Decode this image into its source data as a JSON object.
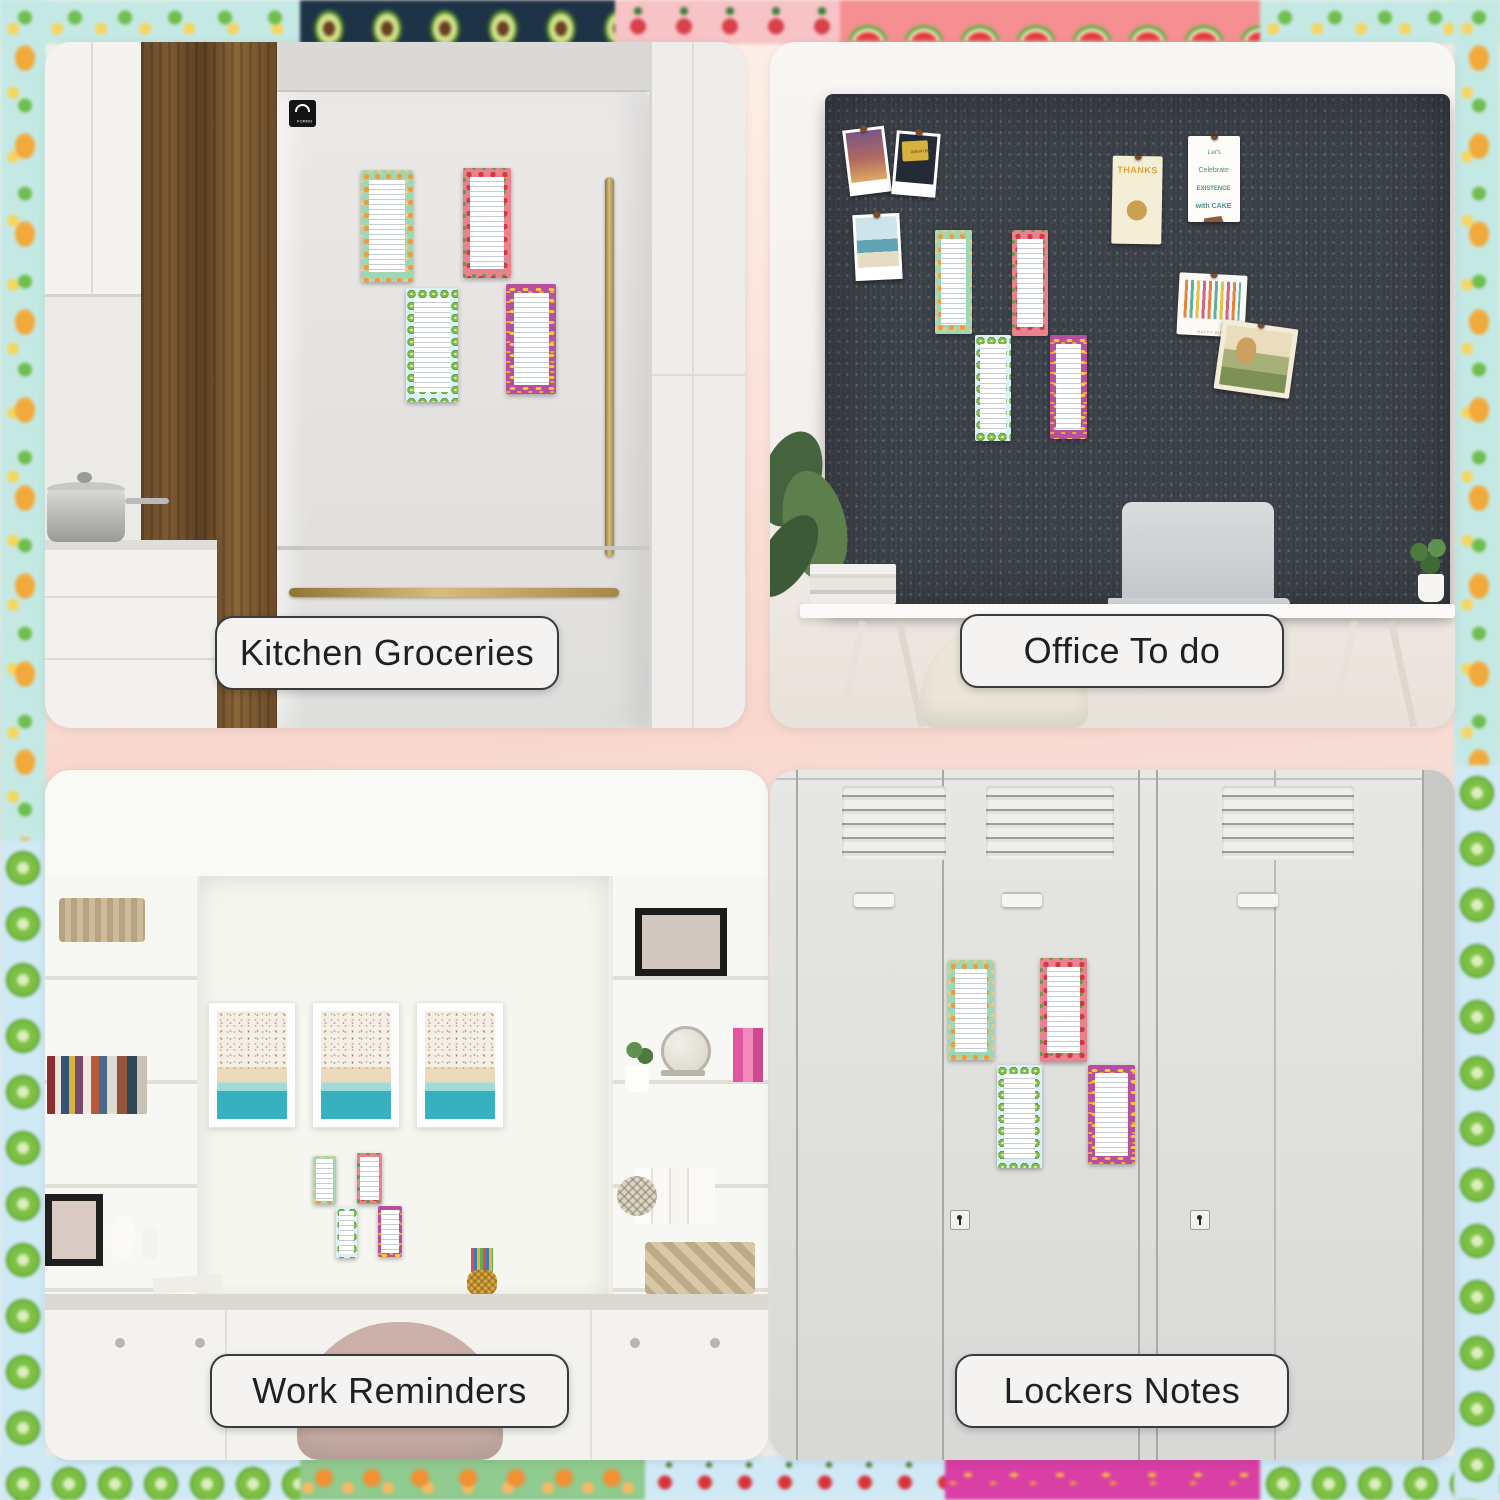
{
  "collage": {
    "type": "magnetic fruit notepads - four lifestyle scenes",
    "quadrants": {
      "kitchen": {
        "label": "Kitchen Groceries",
        "scene": "refrigerator"
      },
      "office": {
        "label": "Office To do",
        "scene": "fabric-bulletin-board-desk"
      },
      "work": {
        "label": "Work Reminders",
        "scene": "home-office-built-in-shelves"
      },
      "lockers": {
        "label": "Lockers Notes",
        "scene": "metal-lockers"
      }
    },
    "fridge_badge": "FORNO",
    "board": {
      "polaroids": [
        "palm-trees-sunset",
        "saturn-bar-sign",
        "beach-shore"
      ],
      "saturn_sign_text": "Saturn Bar",
      "thanks_card_text": "THANKS",
      "cake_card_lines": [
        "Let's",
        "Celebrate",
        "EXISTENCE",
        "with CAKE"
      ],
      "candles_card_text": "HAPPY BIRTHDAY",
      "cards": [
        "thanks-card",
        "existence-cake-card",
        "birthday-candles-card",
        "mermaid-card"
      ]
    },
    "notepads": {
      "description": "to-do list pads, white ruled paper with fruit-pattern borders",
      "variants": [
        {
          "name": "orange",
          "frame_color": "#9fd7b5",
          "fruit_color": "#f39a3f"
        },
        {
          "name": "watermelon",
          "frame_color": "#e8828e",
          "fruit_color": "#cf3a44"
        },
        {
          "name": "kiwi",
          "frame_color": "#dcf0f7",
          "fruit_color": "#84bf45"
        },
        {
          "name": "banana",
          "frame_color": "#b6509e",
          "fruit_color": "#f6c83e"
        }
      ]
    },
    "border_fruits": [
      "pineapple",
      "avocado",
      "strawberry",
      "watermelon",
      "kiwi",
      "orange",
      "cherry",
      "banana"
    ],
    "colors": {
      "gutter_pink": "#f8d6ce",
      "board_charcoal": "#3a3f47",
      "gold_handle": "#d7bc80",
      "pill_bg": "#f4f3f1",
      "pill_border": "#3a3a3a",
      "locker_gray": "#dededc"
    }
  }
}
